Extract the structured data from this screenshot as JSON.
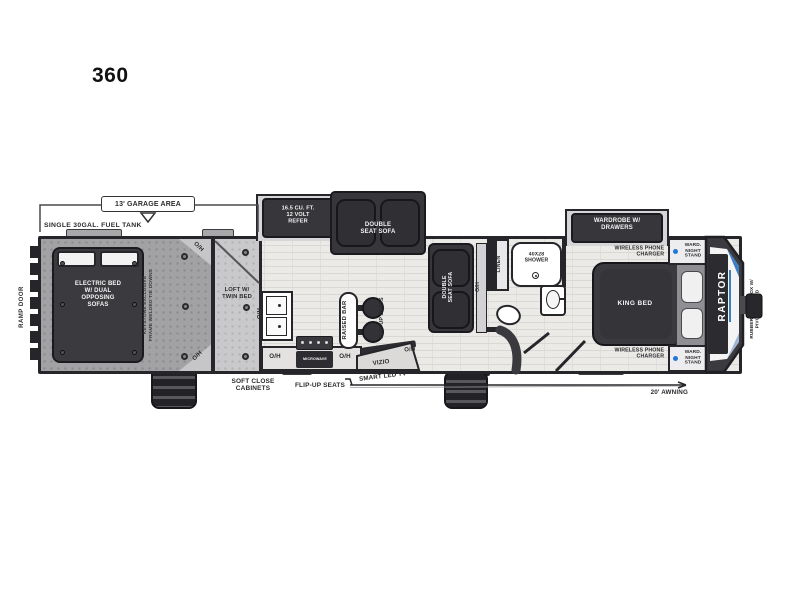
{
  "title": "360",
  "colors": {
    "accent_blue": "#2377d8",
    "logo_blue": "#3d7fc4",
    "line_dark": "#26262a"
  },
  "labels": {
    "garage_area": "13' GARAGE AREA",
    "fuel_tank": "SINGLE 30GAL. FUEL TANK",
    "ramp_door": "RAMP DOOR",
    "electric_bed": "ELECTRIC BED\nW/ DUAL\nOPPOSING\nSOFAS",
    "keystone": "KEYSTONE EXCLUSIVE\nFRAME WELDED TIE DOWNS",
    "loft": "LOFT W/\nTWIN BED",
    "oh": "O/H",
    "refer": "16.5 CU. FT.\n12 VOLT\nREFER",
    "double_seat_sofa": "DOUBLE\nSEAT SOFA",
    "raised_bar": "RAISED BAR",
    "flip_up_seats": "FLIP-UP SEATS",
    "microwave": "MICROWAVE",
    "tv_line1": "VIZIO",
    "tv_line2": "SMART LED TV",
    "soft_close": "SOFT CLOSE\nCABINETS",
    "linen": "LINEN",
    "shower": "40X28\nSHOWER",
    "wardrobe": "WARDROBE W/\nDRAWERS",
    "wireless": "WIRELESS PHONE\nCHARGER",
    "nightstand": "WARD.\nNIGHT\nSTAND",
    "king_bed": "KING BED",
    "awning": "20' AWNING",
    "pinbox": "RUBBERIZED PINBOX W/\nPIVOTING HEAD",
    "logo": "RAPTOR"
  }
}
